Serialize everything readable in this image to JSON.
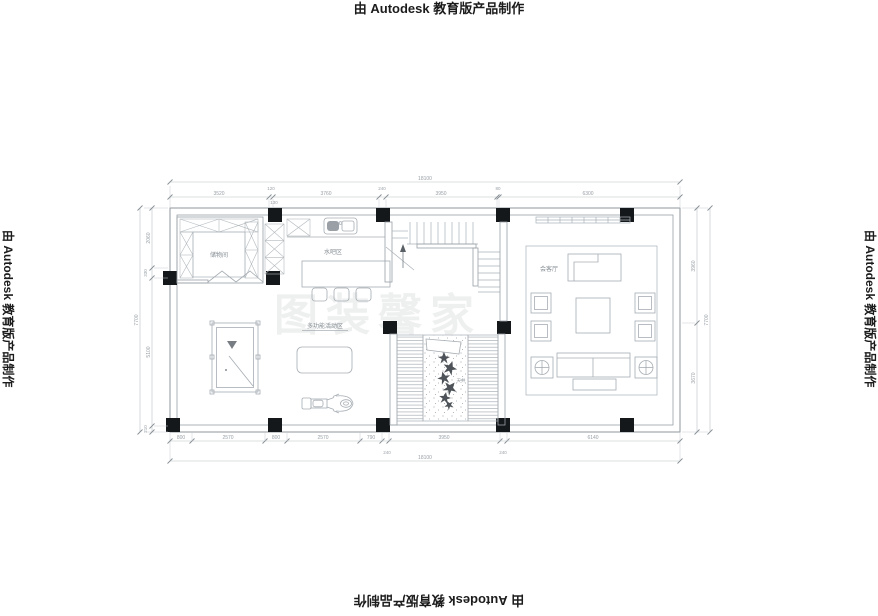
{
  "stamp": {
    "text": "由 Autodesk 教育版产品制作"
  },
  "watermark": {
    "text": "图装馨家"
  },
  "rooms": {
    "storage": "储物间",
    "water_bar": "水吧区",
    "multifunction": "多功能活动区",
    "reception": "会客厅",
    "courtyard": "天井"
  },
  "dims": {
    "top": {
      "overall": "18100",
      "segments": [
        "3520",
        "120",
        "3760",
        "240",
        "3950",
        "80",
        "6300"
      ],
      "sub": "130"
    },
    "bottom": {
      "overall": "18100",
      "segments": [
        "800",
        "2570",
        "800",
        "2570",
        "790",
        "3950",
        "6140"
      ],
      "insets": [
        "240",
        "240"
      ]
    },
    "left": {
      "overall": "7700",
      "segments": [
        "2060",
        "330",
        "5100",
        "210"
      ]
    },
    "right": {
      "overall": "7700",
      "segments": [
        "3960",
        "3670"
      ]
    }
  },
  "colors": {
    "wall_line": "#8f979d",
    "furniture_line": "#a6adb3",
    "dimension_line": "#bcc2c6",
    "dimension_text": "#9aa1a7",
    "column_fill": "#15181b",
    "stamp_text": "#1c1c1c",
    "background": "#ffffff"
  }
}
